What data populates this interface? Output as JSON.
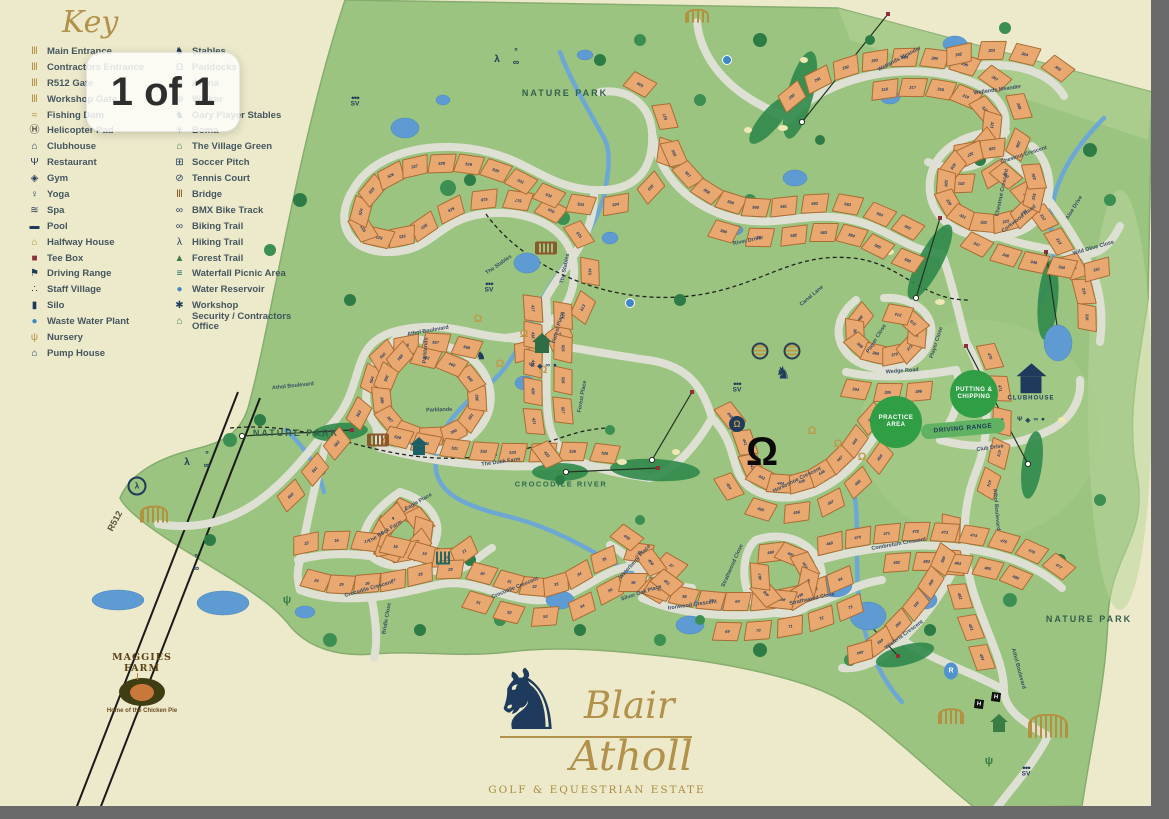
{
  "viewer": {
    "page_indicator": "1 of 1"
  },
  "key": {
    "title": "Key",
    "col1": [
      {
        "label": "Main Entrance",
        "icon": "gate",
        "color": "gold"
      },
      {
        "label": "Contractors Entrance",
        "icon": "gate",
        "color": "gold"
      },
      {
        "label": "R512 Gate",
        "icon": "gate",
        "color": "gold"
      },
      {
        "label": "Workshop Gate",
        "icon": "gate",
        "color": "gold"
      },
      {
        "label": "Fishing Dam",
        "icon": "fish",
        "color": "gold"
      },
      {
        "label": "Helicopter Pad",
        "icon": "helipad",
        "color": "black"
      },
      {
        "label": "Clubhouse",
        "icon": "house",
        "color": "navy"
      },
      {
        "label": "Restaurant",
        "icon": "restaurant",
        "color": "navy"
      },
      {
        "label": "Gym",
        "icon": "gym",
        "color": "navy"
      },
      {
        "label": "Yoga",
        "icon": "yoga",
        "color": "navy"
      },
      {
        "label": "Spa",
        "icon": "spa",
        "color": "navy"
      },
      {
        "label": "Pool",
        "icon": "pool",
        "color": "navy"
      },
      {
        "label": "Halfway House",
        "icon": "house",
        "color": "gold"
      },
      {
        "label": "Tee Box",
        "icon": "teebox",
        "color": "maroon"
      },
      {
        "label": "Driving Range",
        "icon": "flag",
        "color": "navy"
      },
      {
        "label": "Staff Village",
        "icon": "group",
        "color": "navy"
      },
      {
        "label": "Silo",
        "icon": "silo",
        "color": "navy"
      },
      {
        "label": "Waste Water Plant",
        "icon": "dot",
        "color": "blue"
      },
      {
        "label": "Nursery",
        "icon": "plant",
        "color": "gold"
      },
      {
        "label": "Pump House",
        "icon": "house",
        "color": "navy"
      }
    ],
    "col2": [
      {
        "label": "Stables",
        "icon": "horse",
        "color": "navy"
      },
      {
        "label": "Paddocks",
        "icon": "horseshoe",
        "color": "navy"
      },
      {
        "label": "Arena",
        "icon": "ring",
        "color": "navy"
      },
      {
        "label": "Walker",
        "icon": "target",
        "color": "navy"
      },
      {
        "label": "Gary Player Stables",
        "icon": "horse",
        "color": "navy"
      },
      {
        "label": "Boma",
        "icon": "star",
        "color": "navy"
      },
      {
        "label": "The Village Green",
        "icon": "house",
        "color": "green"
      },
      {
        "label": "Soccer Pitch",
        "icon": "grid",
        "color": "navy"
      },
      {
        "label": "Tennis Court",
        "icon": "racket",
        "color": "navy"
      },
      {
        "label": "Bridge",
        "icon": "bridge",
        "color": "brown"
      },
      {
        "label": "BMX Bike Track",
        "icon": "wheel",
        "color": "navy"
      },
      {
        "label": "Biking Trail",
        "icon": "wheel",
        "color": "navy"
      },
      {
        "label": "Hiking Trail",
        "icon": "hiker",
        "color": "navy"
      },
      {
        "label": "Forest Trail",
        "icon": "pine",
        "color": "green"
      },
      {
        "label": "Waterfall Picnic Area",
        "icon": "bars",
        "color": "teal"
      },
      {
        "label": "Water Reservoir",
        "icon": "dot",
        "color": "blue"
      },
      {
        "label": "Workshop",
        "icon": "gear",
        "color": "navy"
      },
      {
        "label": "Security / Contractors Office",
        "icon": "house",
        "color": "green"
      }
    ]
  },
  "map": {
    "route_label": {
      "text": "R512",
      "x": 104,
      "y": 516,
      "rot": -62
    },
    "area_labels": [
      {
        "text": "NATURE PARK",
        "x": 565,
        "y": 93,
        "river": false
      },
      {
        "text": "NATURE PARK",
        "x": 296,
        "y": 433,
        "river": false
      },
      {
        "text": "NATURE PARK",
        "x": 1089,
        "y": 619,
        "river": false
      },
      {
        "text": "CROCODILE RIVER",
        "x": 561,
        "y": 484,
        "river": true
      }
    ],
    "road_labels": [
      {
        "text": "Athol Boulevard",
        "x": 397,
        "y": 326,
        "rot": -10
      },
      {
        "text": "Athol Boulevard",
        "x": 262,
        "y": 381,
        "rot": -6
      },
      {
        "text": "Athol Boulevard",
        "x": 966,
        "y": 505,
        "rot": 85
      },
      {
        "text": "Athol Boulevard",
        "x": 988,
        "y": 664,
        "rot": 75
      },
      {
        "text": "Wetlands Meander",
        "x": 864,
        "y": 54,
        "rot": -28
      },
      {
        "text": "Wetlands Meander",
        "x": 962,
        "y": 85,
        "rot": -8
      },
      {
        "text": "Aloe Drive",
        "x": 1054,
        "y": 203,
        "rot": -58
      },
      {
        "text": "Chestnut Crescent",
        "x": 988,
        "y": 150,
        "rot": -18
      },
      {
        "text": "Chestnut Crescent",
        "x": 966,
        "y": 188,
        "rot": -78
      },
      {
        "text": "Corkwood Road",
        "x": 988,
        "y": 214,
        "rot": -38
      },
      {
        "text": "Wild Olive Close",
        "x": 1062,
        "y": 243,
        "rot": -16
      },
      {
        "text": "River Drive",
        "x": 726,
        "y": 236,
        "rot": -12
      },
      {
        "text": "Canal Lane",
        "x": 790,
        "y": 291,
        "rot": -40
      },
      {
        "text": "Player Close",
        "x": 852,
        "y": 334,
        "rot": -58
      },
      {
        "text": "Player Close",
        "x": 912,
        "y": 338,
        "rot": -72
      },
      {
        "text": "Wedge Road",
        "x": 878,
        "y": 366,
        "rot": -4
      },
      {
        "text": "Club Drive",
        "x": 970,
        "y": 443,
        "rot": -8
      },
      {
        "text": "The Stables",
        "x": 476,
        "y": 260,
        "rot": -35
      },
      {
        "text": "The Stables",
        "x": 542,
        "y": 264,
        "rot": -78
      },
      {
        "text": "Forest Place",
        "x": 534,
        "y": 323,
        "rot": -74
      },
      {
        "text": "Forest Place",
        "x": 558,
        "y": 392,
        "rot": -80
      },
      {
        "text": "Parklands",
        "x": 406,
        "y": 346,
        "rot": -86
      },
      {
        "text": "Parklands",
        "x": 420,
        "y": 405,
        "rot": -2
      },
      {
        "text": "The Duck Farm",
        "x": 472,
        "y": 457,
        "rot": -8
      },
      {
        "text": "Eagle Place",
        "x": 396,
        "y": 497,
        "rot": -30
      },
      {
        "text": "The Rock Farm",
        "x": 356,
        "y": 527,
        "rot": -32
      },
      {
        "text": "Crocodile Crescent",
        "x": 332,
        "y": 584,
        "rot": -16
      },
      {
        "text": "Crocodile Crescent",
        "x": 478,
        "y": 583,
        "rot": -22
      },
      {
        "text": "Bridle Close",
        "x": 363,
        "y": 614,
        "rot": -80
      },
      {
        "text": "Waterberry Place",
        "x": 602,
        "y": 557,
        "rot": -48
      },
      {
        "text": "Silver Oak Place",
        "x": 610,
        "y": 588,
        "rot": -18
      },
      {
        "text": "Ironwood Crescent",
        "x": 656,
        "y": 600,
        "rot": -8
      },
      {
        "text": "Strathwood Close",
        "x": 698,
        "y": 561,
        "rot": -66
      },
      {
        "text": "Strathwood Close",
        "x": 778,
        "y": 594,
        "rot": -12
      },
      {
        "text": "Combretum Crescent",
        "x": 858,
        "y": 539,
        "rot": -10
      },
      {
        "text": "Wisteria Crescent",
        "x": 870,
        "y": 630,
        "rot": -36
      },
      {
        "text": "Horseshoe Crescent",
        "x": 758,
        "y": 475,
        "rot": -26
      }
    ],
    "amenities": {
      "practice_area": "PRACTICE AREA",
      "putting": "PUTTING & CHIPPING",
      "driving_range": "DRIVING RANGE",
      "clubhouse": "CLUBHOUSE"
    },
    "plot_runs": [
      {
        "rid": "stables",
        "t0": 0.02,
        "t1": 0.98,
        "side": -1,
        "start": 511,
        "sp": 30
      },
      {
        "rid": "atholW",
        "t0": 0.3,
        "t1": 0.95,
        "side": -1,
        "start": 560,
        "sp": 34
      },
      {
        "rid": "parklands",
        "t0": 0.05,
        "t1": 0.95,
        "side": 1,
        "start": 384,
        "sp": 30
      },
      {
        "rid": "riverdr",
        "t0": 0.08,
        "t1": 0.95,
        "side": 1,
        "start": 556,
        "sp": 30
      },
      {
        "rid": "riverdr",
        "t0": 0.35,
        "t1": 0.95,
        "side": -1,
        "start": 580,
        "sp": 32
      },
      {
        "rid": "wetlands",
        "t0": 0.05,
        "t1": 0.95,
        "side": 1,
        "start": 290,
        "sp": 28
      },
      {
        "rid": "wetlands",
        "t0": 0.3,
        "t1": 0.9,
        "side": -1,
        "start": 316,
        "sp": 30
      },
      {
        "rid": "wetspur",
        "t0": 0.15,
        "t1": 0.9,
        "side": 1,
        "start": 302,
        "sp": 30
      },
      {
        "rid": "aloe",
        "t0": 0.1,
        "t1": 0.95,
        "side": -1,
        "start": 310,
        "sp": 30
      },
      {
        "rid": "chestnut",
        "t0": 0.05,
        "t1": 0.95,
        "side": 1,
        "start": 326,
        "sp": 28
      },
      {
        "rid": "corkwood",
        "t0": 0.05,
        "t1": 0.9,
        "side": -1,
        "start": 347,
        "sp": 28
      },
      {
        "rid": "player",
        "t0": 0.05,
        "t1": 0.95,
        "side": 1,
        "start": 366,
        "sp": 26
      },
      {
        "rid": "wedge",
        "t0": 0.1,
        "t1": 0.9,
        "side": -1,
        "start": 394,
        "sp": 30
      },
      {
        "rid": "atholE",
        "t0": 0.05,
        "t1": 0.35,
        "side": 1,
        "start": 470,
        "sp": 30
      },
      {
        "rid": "atholE",
        "t0": 0.45,
        "t1": 0.8,
        "side": -1,
        "start": 480,
        "sp": 32
      },
      {
        "rid": "hshoeC",
        "t0": 0.03,
        "t1": 0.97,
        "side": 1,
        "start": 440,
        "sp": 26
      },
      {
        "rid": "hshoeC",
        "t0": 0.25,
        "t1": 0.85,
        "side": -1,
        "start": 454,
        "sp": 30
      },
      {
        "rid": "duckfarm",
        "t0": 0.05,
        "t1": 0.9,
        "side": 1,
        "start": 529,
        "sp": 30
      },
      {
        "rid": "eagle",
        "t0": 0.05,
        "t1": 0.95,
        "side": -1,
        "start": 1,
        "sp": 24
      },
      {
        "rid": "rockfarm",
        "t0": 0.05,
        "t1": 0.95,
        "side": 1,
        "start": 15,
        "sp": 28
      },
      {
        "rid": "crocC",
        "t0": 0.03,
        "t1": 0.97,
        "side": 1,
        "start": 24,
        "sp": 28
      },
      {
        "rid": "crocC",
        "t0": 0.45,
        "t1": 0.95,
        "side": -1,
        "start": 51,
        "sp": 32
      },
      {
        "rid": "ironwood",
        "t0": 0.05,
        "t1": 0.95,
        "side": 1,
        "start": 57,
        "sp": 28
      },
      {
        "rid": "ironwood",
        "t0": 0.35,
        "t1": 0.95,
        "side": -1,
        "start": 69,
        "sp": 30
      },
      {
        "rid": "strath",
        "t0": 0.05,
        "t1": 0.95,
        "side": -1,
        "start": 460,
        "sp": 28
      },
      {
        "rid": "waterb",
        "t0": 0.1,
        "t1": 0.9,
        "side": 1,
        "start": 449,
        "sp": 30
      },
      {
        "rid": "combretum",
        "t0": 0.05,
        "t1": 0.95,
        "side": 1,
        "start": 469,
        "sp": 28
      },
      {
        "rid": "combretum",
        "t0": 0.3,
        "t1": 0.9,
        "side": -1,
        "start": 482,
        "sp": 32
      },
      {
        "rid": "wisteria",
        "t0": 0.1,
        "t1": 0.9,
        "side": -1,
        "start": 489,
        "sp": 28
      },
      {
        "rid": "forestpl",
        "t0": 0.05,
        "t1": 0.95,
        "side": -1,
        "start": 417,
        "sp": 28
      },
      {
        "rid": "forestpl",
        "t0": 0.1,
        "t1": 0.8,
        "side": 1,
        "start": 524,
        "sp": 32
      }
    ],
    "markers": [
      {
        "type": "sv-badge",
        "x": 355,
        "y": 102
      },
      {
        "type": "sv-badge",
        "x": 489,
        "y": 288
      },
      {
        "type": "sv-badge",
        "x": 737,
        "y": 388
      },
      {
        "type": "sv-badge",
        "x": 1026,
        "y": 772
      },
      {
        "type": "gate",
        "x": 1048,
        "y": 726,
        "size": 36,
        "name": "main-entrance"
      },
      {
        "type": "gate",
        "x": 951,
        "y": 716,
        "size": 22,
        "name": "workshop-gate"
      },
      {
        "type": "gate",
        "x": 154,
        "y": 514,
        "size": 24,
        "name": "r512-gate"
      },
      {
        "type": "gate",
        "x": 697,
        "y": 16,
        "size": 20,
        "name": "contractors-entrance"
      },
      {
        "type": "helipad",
        "x": 979,
        "y": 704
      },
      {
        "type": "helipad",
        "x": 996,
        "y": 697
      },
      {
        "type": "stables-circle",
        "x": 737,
        "y": 424
      },
      {
        "type": "horseshoe",
        "x": 812,
        "y": 430
      },
      {
        "type": "horseshoe",
        "x": 838,
        "y": 443
      },
      {
        "type": "horseshoe",
        "x": 862,
        "y": 456
      },
      {
        "type": "horseshoe",
        "x": 478,
        "y": 318
      },
      {
        "type": "horseshoe",
        "x": 524,
        "y": 333
      },
      {
        "type": "horseshoe",
        "x": 500,
        "y": 363
      },
      {
        "type": "horseshoe",
        "x": 543,
        "y": 369
      },
      {
        "type": "horseshoe-big",
        "x": 762,
        "y": 452
      },
      {
        "type": "horse-head",
        "x": 783,
        "y": 374
      },
      {
        "type": "ring",
        "x": 760,
        "y": 351
      },
      {
        "type": "ring",
        "x": 792,
        "y": 351
      },
      {
        "type": "house",
        "x": 1031,
        "y": 382,
        "size": 30,
        "color": "#1e3a5c",
        "labeled": true
      },
      {
        "type": "house",
        "x": 542,
        "y": 343,
        "size": 20,
        "color": "#2e6e46"
      },
      {
        "type": "house",
        "x": 419,
        "y": 446,
        "size": 18,
        "color": "#1d5f66"
      },
      {
        "type": "house",
        "x": 999,
        "y": 723,
        "size": 18,
        "color": "#3a7d44"
      },
      {
        "type": "bridge",
        "x": 378,
        "y": 440
      },
      {
        "type": "bridge",
        "x": 546,
        "y": 248
      },
      {
        "type": "waterfall",
        "x": 443,
        "y": 558
      },
      {
        "type": "plant",
        "x": 989,
        "y": 760
      },
      {
        "type": "plant",
        "x": 287,
        "y": 599
      },
      {
        "type": "bmx",
        "x": 137,
        "y": 486
      },
      {
        "type": "hiker",
        "x": 497,
        "y": 58
      },
      {
        "type": "cyclist",
        "x": 516,
        "y": 60
      },
      {
        "type": "hiker",
        "x": 187,
        "y": 461
      },
      {
        "type": "cyclist",
        "x": 207,
        "y": 463
      },
      {
        "type": "cyclist",
        "x": 196,
        "y": 566
      },
      {
        "type": "rider",
        "x": 481,
        "y": 355
      },
      {
        "type": "reservoir-r",
        "x": 951,
        "y": 671
      },
      {
        "type": "blue-dot",
        "x": 727,
        "y": 60
      },
      {
        "type": "blue-dot",
        "x": 630,
        "y": 303
      },
      {
        "type": "amenity-row",
        "x": 1031,
        "y": 420
      },
      {
        "type": "amenity-row",
        "x": 543,
        "y": 366
      }
    ],
    "maggies_farm": {
      "line1": "MAGGIES",
      "line2": "FARM",
      "tagline": "Home of the Chicken Pie"
    },
    "logo": {
      "name1": "Blair",
      "name2": "Atholl",
      "subtitle": "GOLF & EQUESTRIAN ESTATE",
      "horse_icon": "horse-silhouette"
    }
  },
  "colors": {
    "page_cream": "#edeacb",
    "map_green": "#9ac47f",
    "road": "#dfe0d4",
    "plot": "#e9a870",
    "water": "#5e9bd3",
    "navy": "#1e3a5c",
    "gold": "#b3913f",
    "amenity_green": "#2f9e44",
    "frame_gray": "#6a6a6a"
  }
}
